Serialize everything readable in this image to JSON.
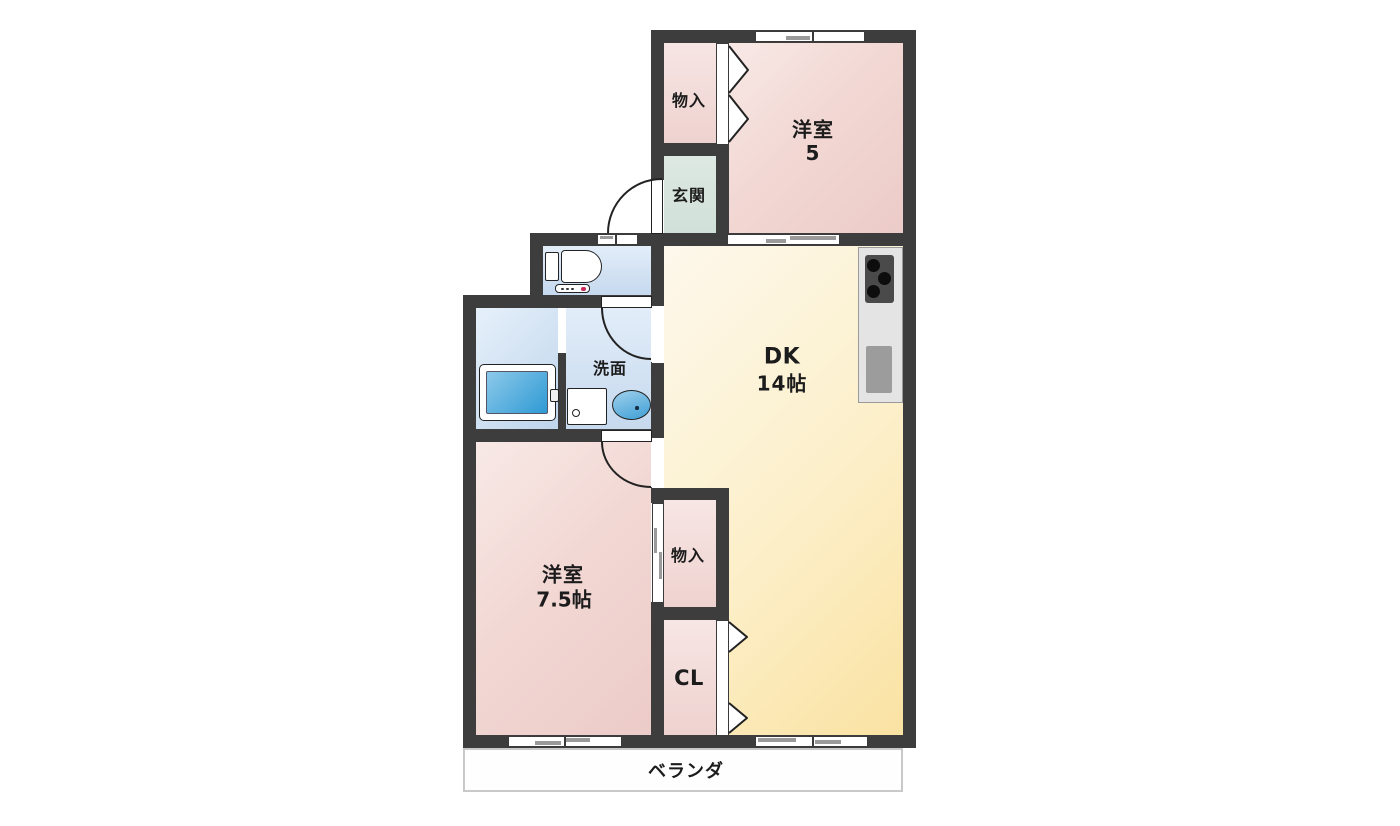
{
  "floor_plan": {
    "rooms": {
      "storage_top": {
        "label": "物入"
      },
      "western_room_5": {
        "label": "洋室",
        "size": "5"
      },
      "entrance": {
        "label": "玄関"
      },
      "dining_kitchen": {
        "label": "DK",
        "size": "14帖"
      },
      "washroom": {
        "label": "洗面"
      },
      "western_room_7_5": {
        "label": "洋室",
        "size": "7.5帖"
      },
      "storage_bottom": {
        "label": "物入"
      },
      "closet": {
        "label": "CL"
      },
      "veranda": {
        "label": "ベランダ"
      }
    },
    "colors": {
      "wall": "#3d3d3d",
      "western_room_fill": "#efd2ce",
      "dk_fill": "#fbe5ab",
      "entrance_fill": "#d8e5df",
      "wet_area_fill": "#cfdff1",
      "bathtub_fill": "#45a8da",
      "kitchen_counter": "#e4e4e4",
      "veranda_border": "#c9c9c9"
    }
  }
}
